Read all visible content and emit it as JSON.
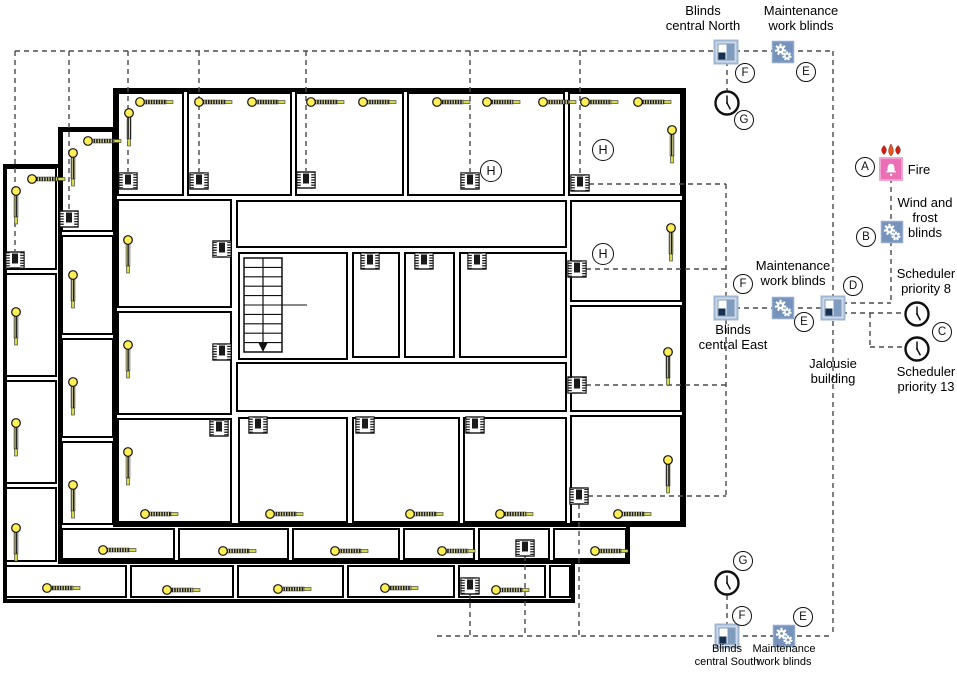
{
  "colors": {
    "wall": "#000000",
    "dash": "#4a4a4a",
    "blind_yellow": "#ffee55",
    "blind_tip": "#d8d84f",
    "node_blue": "#7593bd",
    "node_blue_light": "#ccd9ea",
    "node_blue_border": "#9fb7d3",
    "panel_blue": "#7e9bc0",
    "panel_dark": "#16304f",
    "fire_pink": "#ec6eb5",
    "fire_pink_border": "#f3a3d1",
    "flame_red": "#d21e12",
    "flame_orange": "#e8591c"
  },
  "diagram": {
    "floors": [
      {
        "x": 3,
        "y": 164,
        "w": 572,
        "h": 439,
        "rooms": [
          [
            5,
            167,
            52,
            103
          ],
          [
            5,
            273,
            52,
            104
          ],
          [
            5,
            380,
            52,
            104
          ],
          [
            5,
            487,
            52,
            75
          ],
          [
            5,
            565,
            122,
            33
          ],
          [
            130,
            565,
            104,
            33
          ],
          [
            237,
            565,
            107,
            33
          ],
          [
            347,
            565,
            108,
            33
          ],
          [
            458,
            565,
            88,
            33
          ],
          [
            549,
            565,
            22,
            33
          ]
        ]
      },
      {
        "x": 58,
        "y": 127,
        "w": 572,
        "h": 437,
        "rooms": [
          [
            61,
            130,
            53,
            102
          ],
          [
            61,
            235,
            53,
            100
          ],
          [
            61,
            338,
            53,
            100
          ],
          [
            61,
            441,
            53,
            84
          ],
          [
            61,
            528,
            114,
            32
          ],
          [
            178,
            528,
            111,
            32
          ],
          [
            292,
            528,
            108,
            32
          ],
          [
            403,
            528,
            72,
            32
          ],
          [
            478,
            528,
            72,
            32
          ],
          [
            553,
            528,
            74,
            32
          ]
        ]
      },
      {
        "x": 113,
        "y": 88,
        "w": 573,
        "h": 439,
        "rooms": [
          [
            117,
            92,
            67,
            104
          ],
          [
            187,
            92,
            105,
            104
          ],
          [
            295,
            92,
            109,
            104
          ],
          [
            407,
            92,
            158,
            104
          ],
          [
            568,
            92,
            114,
            104
          ],
          [
            117,
            199,
            115,
            109
          ],
          [
            117,
            311,
            115,
            104
          ],
          [
            117,
            418,
            115,
            105
          ],
          [
            570,
            200,
            112,
            102
          ],
          [
            570,
            305,
            112,
            107
          ],
          [
            570,
            415,
            112,
            108
          ],
          [
            236,
            200,
            331,
            48
          ],
          [
            238,
            252,
            110,
            108
          ],
          [
            352,
            252,
            48,
            106
          ],
          [
            404,
            252,
            51,
            106
          ],
          [
            459,
            252,
            108,
            106
          ],
          [
            236,
            362,
            331,
            50
          ],
          [
            238,
            417,
            110,
            106
          ],
          [
            352,
            417,
            108,
            106
          ],
          [
            463,
            417,
            104,
            106
          ]
        ]
      }
    ],
    "stairs": {
      "x": 244,
      "y": 258,
      "w": 38,
      "h": 94,
      "treads": 9,
      "center_x": 263,
      "arrow_y": 342,
      "mid_y": 305,
      "mid_x2": 307
    },
    "dashed_lines": [
      [
        15,
        51,
        833,
        51
      ],
      [
        833,
        51,
        833,
        636
      ],
      [
        437,
        636,
        833,
        636
      ],
      [
        15,
        51,
        15,
        251
      ],
      [
        69,
        51,
        69,
        210
      ],
      [
        128,
        51,
        128,
        172
      ],
      [
        199,
        51,
        199,
        172
      ],
      [
        306,
        51,
        306,
        171
      ],
      [
        470,
        51,
        470,
        172
      ],
      [
        580,
        51,
        580,
        174
      ],
      [
        727,
        52,
        727,
        92
      ],
      [
        727,
        595,
        727,
        636
      ],
      [
        589,
        184,
        726,
        184
      ],
      [
        586,
        269,
        726,
        269
      ],
      [
        586,
        385,
        726,
        385
      ],
      [
        588,
        496,
        726,
        496
      ],
      [
        726,
        184,
        726,
        496
      ],
      [
        726,
        308,
        833,
        308
      ],
      [
        833,
        303,
        891,
        303
      ],
      [
        891,
        169,
        891,
        303
      ],
      [
        833,
        313,
        904,
        313
      ],
      [
        870,
        313,
        870,
        347
      ],
      [
        870,
        347,
        904,
        347
      ],
      [
        470,
        594,
        470,
        636
      ],
      [
        525,
        556,
        525,
        636
      ],
      [
        579,
        504,
        579,
        636
      ]
    ],
    "devices": {
      "blind_h": [
        [
          32,
          179
        ],
        [
          47,
          588
        ],
        [
          167,
          590
        ],
        [
          278,
          589
        ],
        [
          385,
          588
        ],
        [
          496,
          590
        ],
        [
          88,
          141
        ],
        [
          103,
          550
        ],
        [
          223,
          551
        ],
        [
          335,
          551
        ],
        [
          442,
          551
        ],
        [
          595,
          551
        ],
        [
          140,
          102
        ],
        [
          199,
          102
        ],
        [
          252,
          102
        ],
        [
          311,
          102
        ],
        [
          363,
          102
        ],
        [
          437,
          102
        ],
        [
          487,
          102
        ],
        [
          543,
          102
        ],
        [
          585,
          102
        ],
        [
          638,
          102
        ],
        [
          145,
          514
        ],
        [
          270,
          514
        ],
        [
          410,
          514
        ],
        [
          500,
          514
        ],
        [
          618,
          514
        ]
      ],
      "blind_v": [
        [
          16,
          191
        ],
        [
          16,
          312
        ],
        [
          16,
          423
        ],
        [
          16,
          528
        ],
        [
          73,
          153
        ],
        [
          73,
          275
        ],
        [
          73,
          382
        ],
        [
          73,
          485
        ],
        [
          129,
          113
        ],
        [
          128,
          240
        ],
        [
          128,
          345
        ],
        [
          128,
          452
        ],
        [
          672,
          130
        ],
        [
          671,
          228
        ],
        [
          668,
          352
        ],
        [
          668,
          460
        ]
      ],
      "chip": [
        [
          15,
          260
        ],
        [
          69,
          219
        ],
        [
          128,
          181
        ],
        [
          199,
          181
        ],
        [
          306,
          180
        ],
        [
          470,
          181
        ],
        [
          580,
          183
        ],
        [
          222,
          249
        ],
        [
          222,
          352
        ],
        [
          219,
          428
        ],
        [
          577,
          269
        ],
        [
          577,
          385
        ],
        [
          579,
          496
        ],
        [
          370,
          261
        ],
        [
          424,
          261
        ],
        [
          477,
          261
        ],
        [
          258,
          425
        ],
        [
          365,
          425
        ],
        [
          475,
          425
        ],
        [
          470,
          586
        ],
        [
          525,
          548
        ]
      ]
    },
    "nodes": [
      {
        "type": "blinds",
        "x": 726,
        "y": 52,
        "name": "blinds-central-north-icon"
      },
      {
        "type": "gear",
        "x": 783,
        "y": 52,
        "name": "maintenance-work-blinds-north-icon"
      },
      {
        "type": "clock",
        "x": 727,
        "y": 103,
        "name": "scheduler-north-icon"
      },
      {
        "type": "flames",
        "x": 891,
        "y": 150,
        "name": "flames-icon"
      },
      {
        "type": "fire",
        "x": 891,
        "y": 169,
        "name": "fire-icon"
      },
      {
        "type": "gear",
        "x": 892,
        "y": 232,
        "name": "wind-frost-blinds-icon"
      },
      {
        "type": "blinds",
        "x": 726,
        "y": 308,
        "name": "blinds-central-east-icon"
      },
      {
        "type": "gear",
        "x": 783,
        "y": 308,
        "name": "maintenance-work-blinds-east-icon"
      },
      {
        "type": "blinds",
        "x": 833,
        "y": 308,
        "name": "jalousie-building-icon"
      },
      {
        "type": "clock",
        "x": 917,
        "y": 314,
        "name": "scheduler-priority-8-icon"
      },
      {
        "type": "clock",
        "x": 917,
        "y": 349,
        "name": "scheduler-priority-13-icon"
      },
      {
        "type": "clock",
        "x": 727,
        "y": 583,
        "name": "scheduler-south-icon"
      },
      {
        "type": "blinds",
        "x": 727,
        "y": 636,
        "name": "blinds-central-south-icon"
      },
      {
        "type": "gear",
        "x": 784,
        "y": 636,
        "name": "maintenance-work-blinds-south-icon"
      }
    ],
    "badges": [
      {
        "letter": "A",
        "x": 865,
        "y": 167,
        "d": 20
      },
      {
        "letter": "B",
        "x": 866,
        "y": 237,
        "d": 20
      },
      {
        "letter": "C",
        "x": 942,
        "y": 332,
        "d": 20
      },
      {
        "letter": "D",
        "x": 853,
        "y": 286,
        "d": 20
      },
      {
        "letter": "E",
        "x": 806,
        "y": 72,
        "d": 20
      },
      {
        "letter": "F",
        "x": 745,
        "y": 73,
        "d": 20
      },
      {
        "letter": "G",
        "x": 744,
        "y": 120,
        "d": 20
      },
      {
        "letter": "F",
        "x": 743,
        "y": 284,
        "d": 20
      },
      {
        "letter": "E",
        "x": 804,
        "y": 322,
        "d": 20
      },
      {
        "letter": "G",
        "x": 743,
        "y": 561,
        "d": 20
      },
      {
        "letter": "F",
        "x": 742,
        "y": 616,
        "d": 20
      },
      {
        "letter": "E",
        "x": 803,
        "y": 617,
        "d": 20
      },
      {
        "letter": "H",
        "x": 491,
        "y": 171,
        "d": 22
      },
      {
        "letter": "H",
        "x": 603,
        "y": 150,
        "d": 22
      },
      {
        "letter": "H",
        "x": 603,
        "y": 254,
        "d": 22
      }
    ],
    "labels": [
      {
        "name": "label-blinds-central-north",
        "lines": [
          "Blinds",
          "central North"
        ],
        "x": 703,
        "y": 3,
        "size": 13
      },
      {
        "name": "label-maintenance-work-blinds-north",
        "lines": [
          "Maintenance",
          "work blinds"
        ],
        "x": 801,
        "y": 3,
        "size": 13
      },
      {
        "name": "label-fire",
        "lines": [
          "Fire"
        ],
        "x": 919,
        "y": 162,
        "size": 13
      },
      {
        "name": "label-wind-and-frost-blinds",
        "lines": [
          "Wind and",
          "frost",
          "blinds"
        ],
        "x": 925,
        "y": 195,
        "size": 13
      },
      {
        "name": "label-scheduler-priority-8",
        "lines": [
          "Scheduler",
          "priority 8"
        ],
        "x": 926,
        "y": 266,
        "size": 13
      },
      {
        "name": "label-scheduler-priority-13",
        "lines": [
          "Scheduler",
          "priority 13"
        ],
        "x": 926,
        "y": 364,
        "size": 13
      },
      {
        "name": "label-jalousie-building",
        "lines": [
          "Jalousie",
          "building"
        ],
        "x": 833,
        "y": 356,
        "size": 13
      },
      {
        "name": "label-blinds-central-east",
        "lines": [
          "Blinds",
          "central East"
        ],
        "x": 733,
        "y": 322,
        "size": 13
      },
      {
        "name": "label-maintenance-work-blinds-east",
        "lines": [
          "Maintenance",
          "work blinds"
        ],
        "x": 793,
        "y": 258,
        "size": 13
      },
      {
        "name": "label-blinds-central-south",
        "lines": [
          "Blinds",
          "central South"
        ],
        "x": 727,
        "y": 643,
        "size": 11
      },
      {
        "name": "label-maintenance-work-blinds-south",
        "lines": [
          "Maintenance",
          "work blinds"
        ],
        "x": 784,
        "y": 643,
        "size": 11
      }
    ]
  }
}
